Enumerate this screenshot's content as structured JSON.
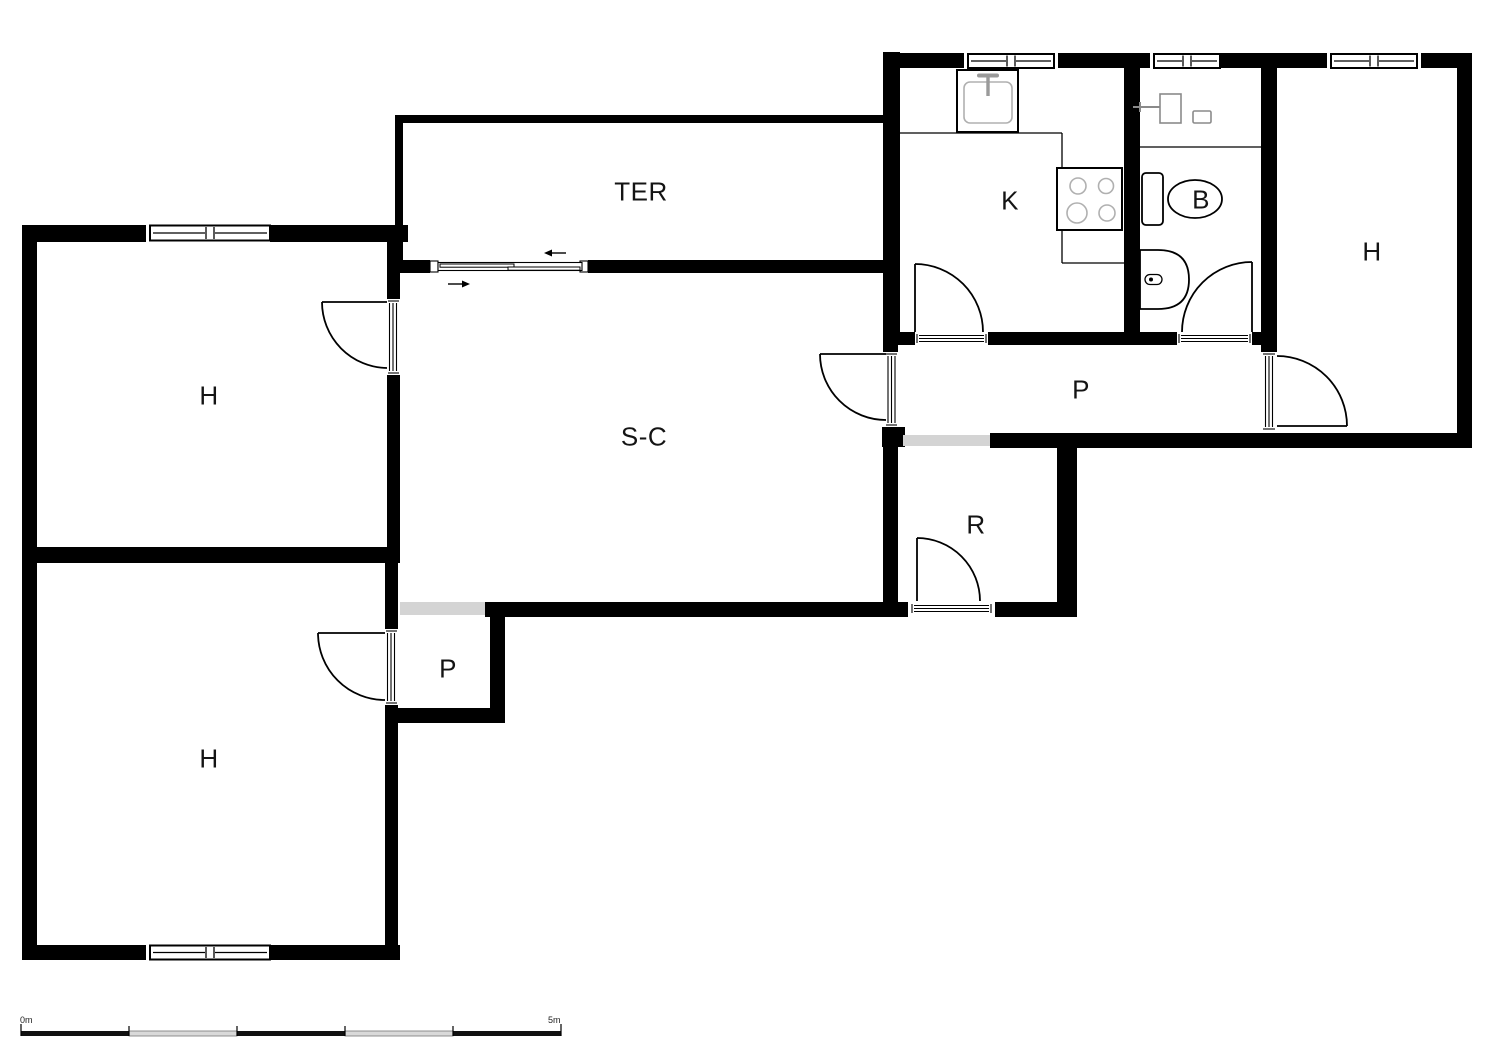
{
  "plan": {
    "type": "floor-plan",
    "wall_color": "#000000",
    "passage_color": "#d4d4d4",
    "fixture_line_color": "#b0b0b0",
    "rooms": [
      {
        "id": "ter",
        "label": "TER",
        "x": 641,
        "y": 192
      },
      {
        "id": "h-top-left",
        "label": "H",
        "x": 209,
        "y": 396
      },
      {
        "id": "s-c",
        "label": "S-C",
        "x": 644,
        "y": 437
      },
      {
        "id": "k",
        "label": "K",
        "x": 1010,
        "y": 201
      },
      {
        "id": "b",
        "label": "B",
        "x": 1201,
        "y": 200
      },
      {
        "id": "h-right",
        "label": "H",
        "x": 1372,
        "y": 252
      },
      {
        "id": "p-right",
        "label": "P",
        "x": 1081,
        "y": 390
      },
      {
        "id": "r",
        "label": "R",
        "x": 976,
        "y": 525
      },
      {
        "id": "p-left",
        "label": "P",
        "x": 448,
        "y": 669
      },
      {
        "id": "h-bottom-left",
        "label": "H",
        "x": 209,
        "y": 759
      }
    ],
    "scale_bar": {
      "start_label": "0m",
      "end_label": "5m"
    }
  }
}
